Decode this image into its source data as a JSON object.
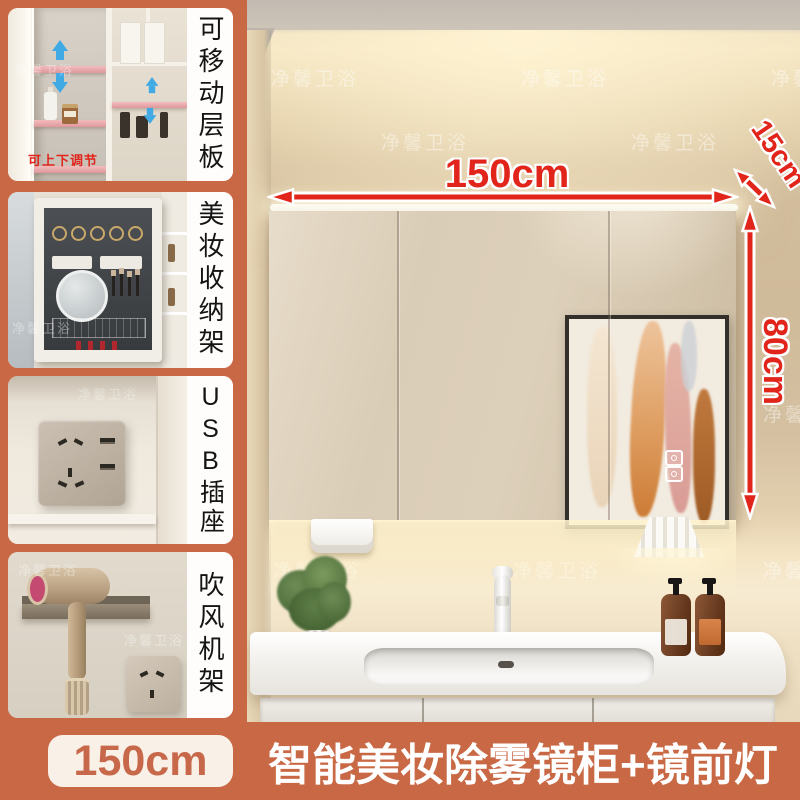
{
  "brand_watermark": "净馨卫浴",
  "sidebar": {
    "panels": [
      {
        "label": "可移动层板",
        "overlay_text": "可上下调节"
      },
      {
        "label": "美妆收纳架"
      },
      {
        "label": "USB插座"
      },
      {
        "label": "吹风机架"
      }
    ]
  },
  "dimensions": {
    "width": "150cm",
    "depth": "15cm",
    "height": "80cm"
  },
  "footer": {
    "size_badge": "150cm",
    "title": "智能美妆除雾镜柜+镜前灯"
  },
  "colors": {
    "accent_orange": "#c96844",
    "annotation_red": "#e1251b",
    "shelf_pink": "#eeadaf",
    "arrow_blue": "#41a9e4"
  }
}
